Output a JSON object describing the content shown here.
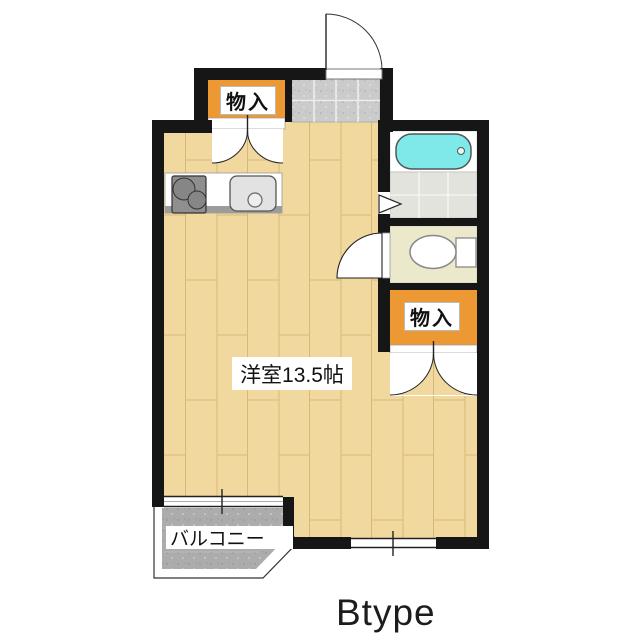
{
  "plan_title": "Btype",
  "rooms": {
    "main_room_label": "洋室13.5帖",
    "storage_top_label": "物入",
    "storage_right_label": "物入",
    "balcony_label": "バルコニー"
  },
  "colors": {
    "wall": "#161616",
    "floor": "#F0D89F",
    "floor_line": "#D8B878",
    "storage_orange": "#EC9933",
    "bathtub_cyan": "#7FE9E9",
    "genkan_tile_gray": "#CBCBCB",
    "washroom_tile": "#E3E3DD",
    "toilet_floor": "#ECE8CB",
    "balcony_gray": "#ACACAC",
    "counter_gray": "#9C9C9C",
    "stove_gray": "#8F8F8F"
  }
}
